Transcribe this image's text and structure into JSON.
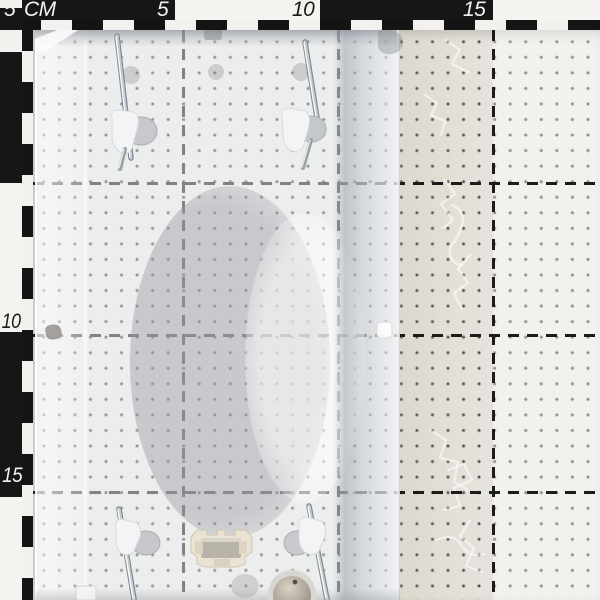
{
  "ruler": {
    "unit_label": "CM",
    "top_labels": [
      "5",
      "10",
      "15"
    ],
    "left_labels": [
      "5",
      "10",
      "15"
    ],
    "tick_interval_cm": 1,
    "block_interval_cm": 5
  },
  "grid": {
    "dot_spacing_cm": 0.5,
    "major_line_spacing_cm": 5
  },
  "colors": {
    "board": "#e9e8e5",
    "ruler_black": "#161616",
    "ruler_white": "#f4f3f0",
    "grid_dot": "#313131",
    "grid_line": "#1c1c1c",
    "glass_tint": "#eef0f3",
    "metal_gray": "#c6c9ce",
    "connector_cream": "#eae3d3",
    "boss_beige": "#b3ac9e",
    "patterned_zone_tint": "#d9d0bf"
  },
  "objects": {
    "glass_panel": "frosted-glass-panel",
    "dome_shadow": "dome-silhouette",
    "mounting_pins": [
      "top-left",
      "top-right",
      "bottom-left",
      "bottom-right"
    ],
    "terminal_block": "terminal-block",
    "threaded_boss": "threaded-boss",
    "patterned_glass": "crackle-patterned-glass"
  }
}
